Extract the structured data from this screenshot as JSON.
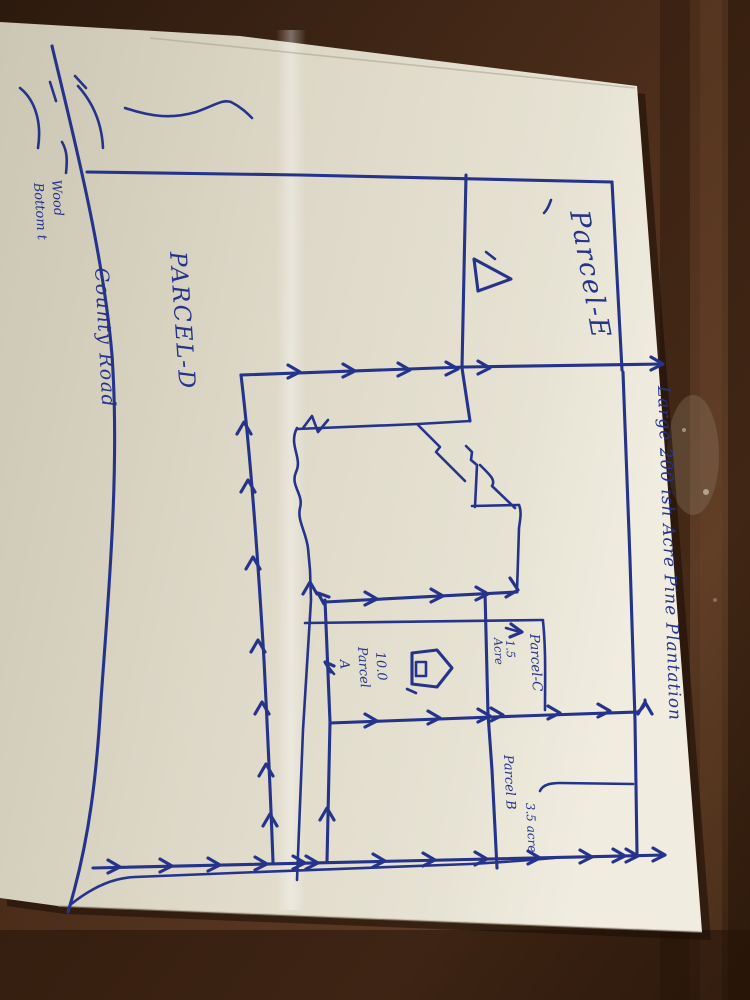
{
  "map": {
    "labels": {
      "creek_note_line1": "Wood",
      "creek_note_line2": "Bottom t",
      "road": "County Road",
      "parcel_d": "PARCEL-D",
      "parcel_e": "Parcel-E",
      "plantation": "Large 200 ish Acre Pine Plantation",
      "parcel_c": "Parcel-C",
      "parcel_c_area_line1": "1.5",
      "parcel_c_area_line2": "Acre",
      "parcel_a_area": "10.0",
      "parcel_a_name_line1": "Parcel",
      "parcel_a_name_line2": "A",
      "parcel_b": "Parcel B",
      "parcel_b_area": "3.5 acre"
    },
    "colors": {
      "ink": "#26338a",
      "paper": "#e2ddcd",
      "wood": "#3a2113"
    }
  }
}
